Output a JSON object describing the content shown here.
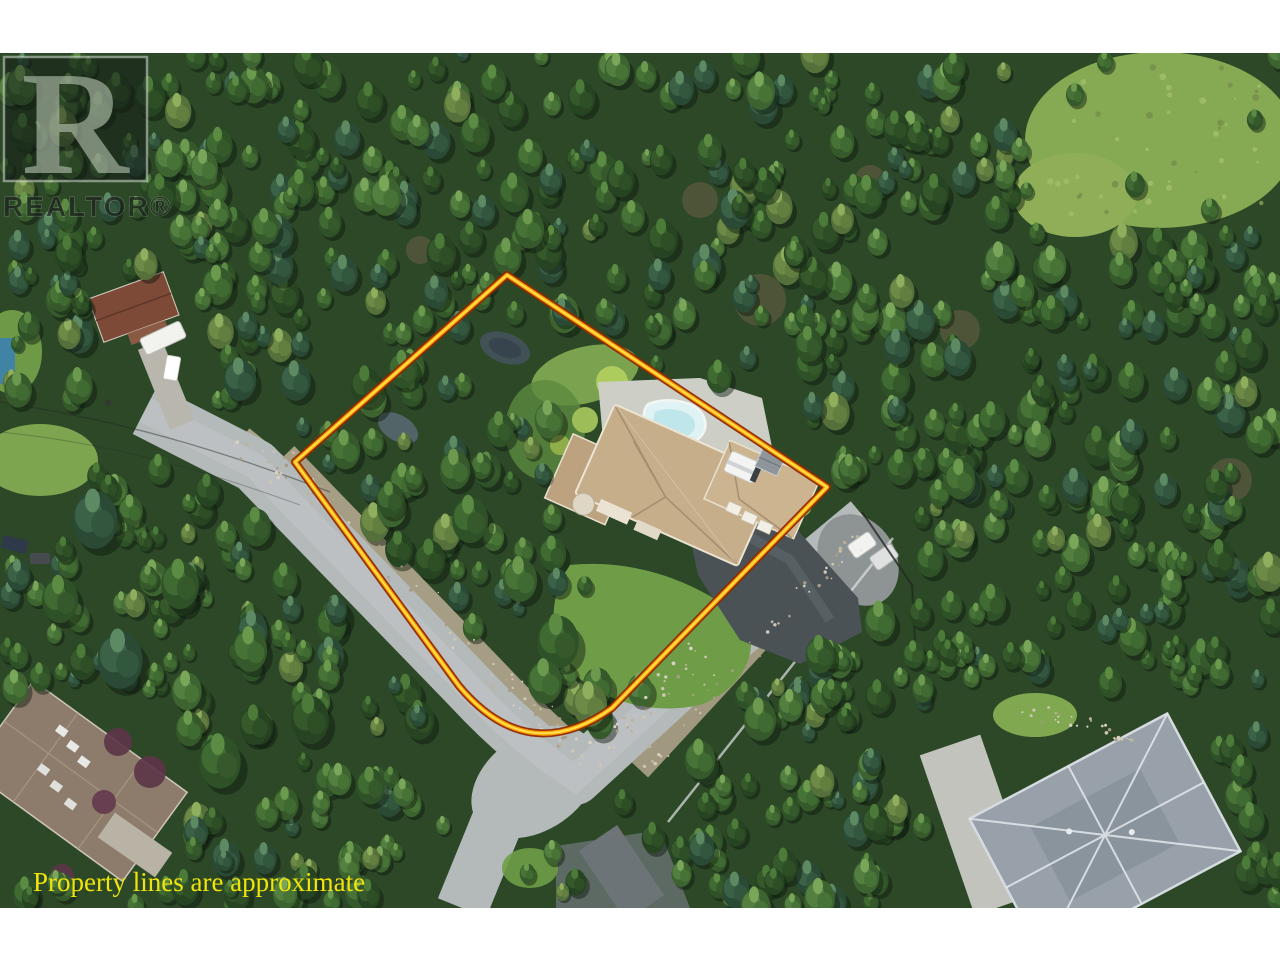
{
  "watermark": {
    "logo_letter": "R",
    "brand_text": "REALTOR®"
  },
  "caption": {
    "text": "Property lines are approximate",
    "color": "#f0e40a"
  },
  "property_outline": {
    "outer_color": "#8f2a00",
    "mid_color": "#ff9d00",
    "inner_color": "#ffe14d"
  },
  "scene": {
    "type": "aerial-drone-photo",
    "subject": "forested residential corner lot outlined in orange",
    "features": [
      "dense evergreen forest",
      "outlined corner property",
      "tan-roof two-storey house",
      "kidney-shaped swimming pool",
      "dark asphalt driveway",
      "white RV camper and shed",
      "curving suburban street with gravel shoulders",
      "street intersection at lot corner",
      "neighbouring red-roof house with trailer",
      "neighbouring brown-roof house with skylights",
      "neighbouring gray-roof house",
      "two parked cars",
      "grass clearing"
    ]
  },
  "palette": {
    "forest_base": "#2c4827",
    "lawn": "#6f9d47",
    "road": "#b4b9ba",
    "house_roof": "#c6ae8b",
    "pool_water": "#dff2f4",
    "driveway_asphalt": "#4a5256",
    "neighbor_roof_red": "#7e4a38",
    "neighbor_roof_brown": "#8d7c6b",
    "neighbor_roof_gray": "#98a1a9",
    "gravel": "#b3a78f"
  }
}
